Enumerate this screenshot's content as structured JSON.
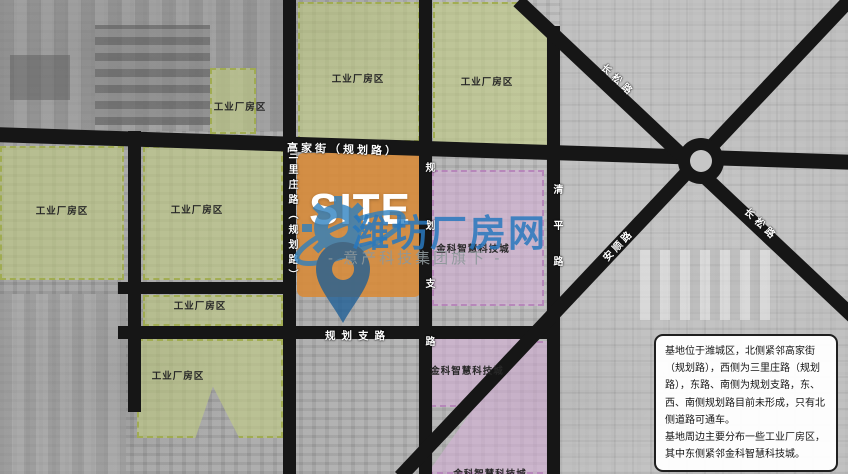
{
  "map": {
    "site": {
      "label": "SITE"
    },
    "zones": {
      "industrial_label": "工业厂房区",
      "jinke_label": "金科智慧科技城"
    },
    "roads": {
      "gaojia": "高家街（规划路）",
      "sanlizhuang": "三里庄路（规划路）",
      "planned_branch_vertical": "规划支路",
      "planned_branch_horizontal": "规划支路",
      "qingping": "清平路",
      "changsong_upper": "长松路",
      "changsong_lower": "长松路",
      "anshun": "安顺路"
    }
  },
  "watermark": {
    "title": "潍坊厂房网",
    "subtitle": "- 意产科技集团旗下 -",
    "title_color": "#2878be",
    "subtitle_color": "#8e989b"
  },
  "infobox": {
    "paragraphs": {
      "p1": "基地位于潍城区，北侧紧邻高家街（规划路），西侧为三里庄路（规划路），东路、南侧为规划支路，东、西、南侧规划路目前未形成，只有北侧道路可通车。",
      "p2": "基地周边主要分布一些工业厂房区，其中东侧紧邻金科智慧科技城。"
    }
  },
  "colors": {
    "site_orange": "#d78b3a",
    "industrial_green": "#c1cd85",
    "jinke_purple": "#d6afd8",
    "road_black": "#161616",
    "watermark_blue": "#2878be"
  }
}
